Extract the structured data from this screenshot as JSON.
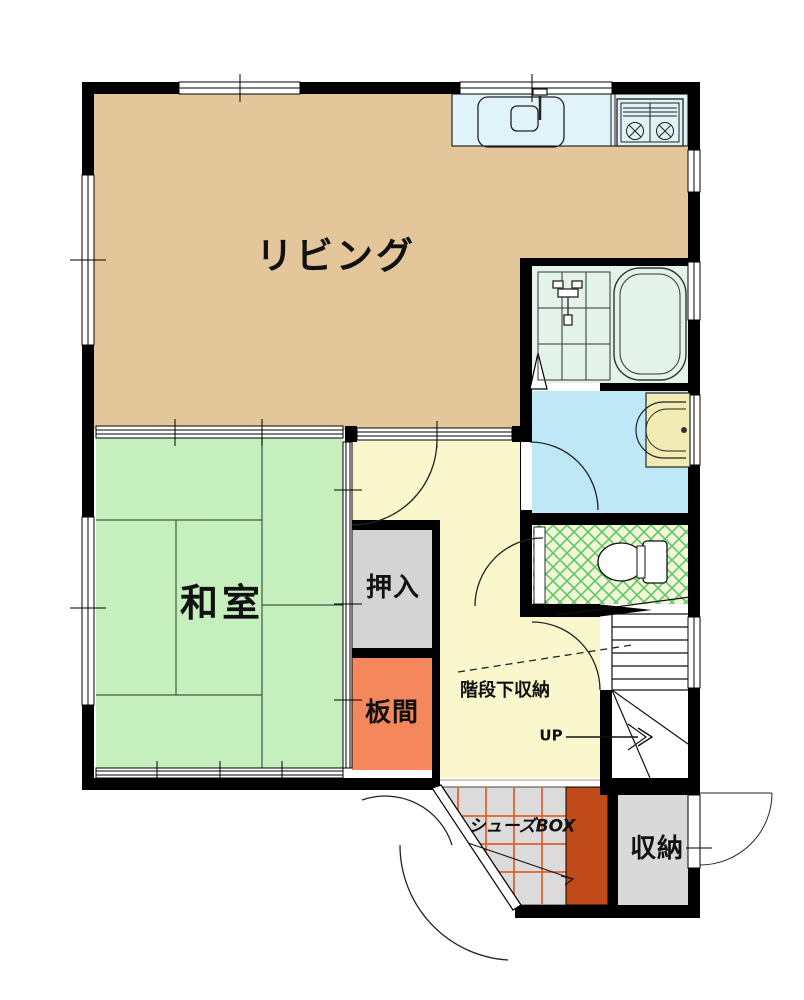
{
  "title": "1F floor plan",
  "rooms": {
    "living": {
      "label": "リビング"
    },
    "washitsu": {
      "label": "和室"
    },
    "oshiire": {
      "label": "押入"
    },
    "itanoma": {
      "label": "板間"
    },
    "stair_storage": {
      "label": "階段下収納"
    },
    "up": {
      "label": "UP"
    },
    "shoes_box": {
      "label": "シューズBOX"
    },
    "storage": {
      "label": "収納"
    }
  },
  "colors": {
    "living": "#E3C79A",
    "kitchen": "#DFF3F8",
    "bath": "#E3F3E9",
    "washroom": "#BEE8F6",
    "toilet_bg": "#F2F6D6",
    "toilet_line": "#5CC868",
    "washitsu": "#C6EFBE",
    "hall": "#FAF7CC",
    "oshiire": "#D4D4D4",
    "itanoma": "#F4875C",
    "shoebox": "#C14A1A",
    "genkan": "#DBDBDB",
    "storage": "#D9D9D9",
    "washbasin": "#F2ECB4",
    "grid_orange": "#E0622F",
    "wall": "#000000"
  }
}
